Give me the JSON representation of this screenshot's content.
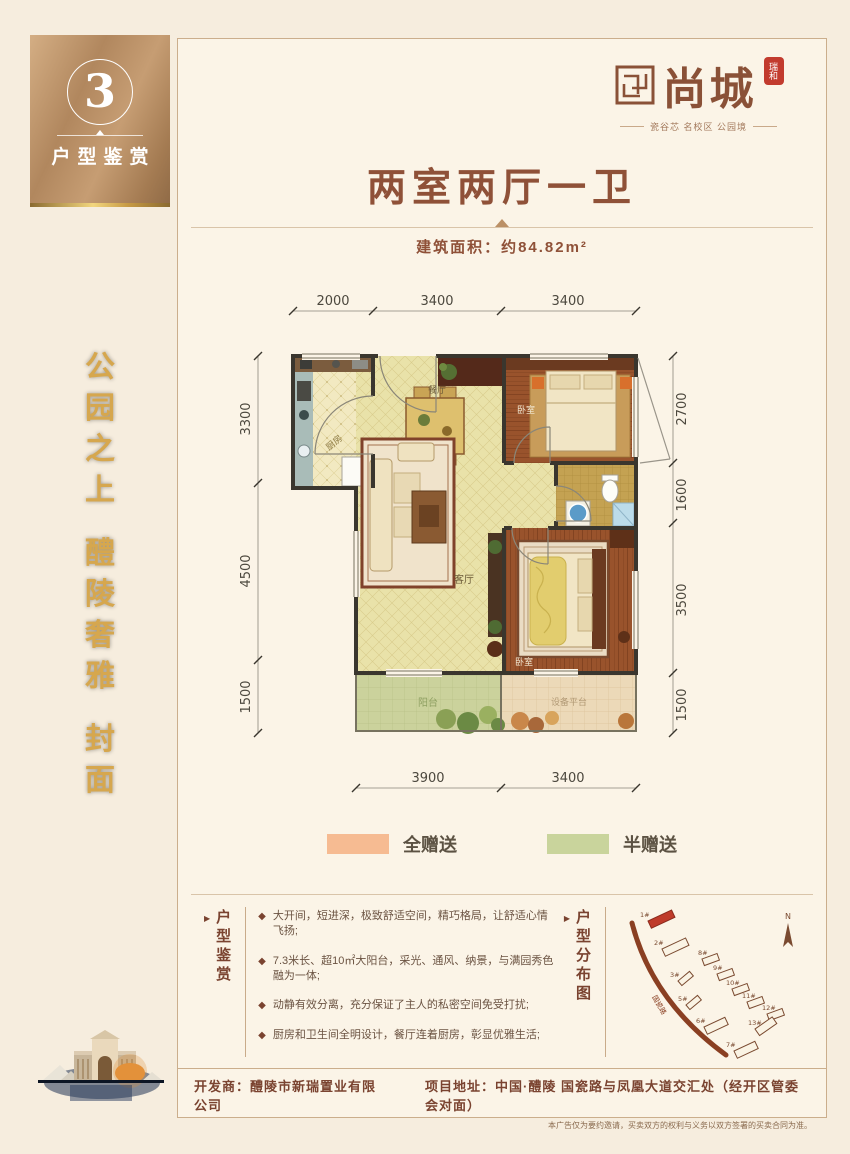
{
  "sidebar": {
    "number": "3",
    "label": "户型鉴赏",
    "slogan_chars": [
      "公",
      "园",
      "之",
      "上",
      "醴",
      "陵",
      "奢",
      "雅",
      "封",
      "面"
    ],
    "colors": {
      "bronze": "#b1875e",
      "navy": "#15223a",
      "gold_text": "#d6a74e"
    }
  },
  "logo": {
    "name": "尚城",
    "seal": "瑞和",
    "tagline": "瓷谷芯 名校区 公园境"
  },
  "header": {
    "title": "两室两厅一卫",
    "area": "建筑面积：约84.82m²"
  },
  "floorplan": {
    "dims_top": [
      "2000",
      "3400",
      "3400"
    ],
    "dims_left": [
      "3300",
      "4500",
      "1500"
    ],
    "dims_right": [
      "2700",
      "1600",
      "3500",
      "1500"
    ],
    "dims_bottom": [
      "3900",
      "3400"
    ],
    "rooms": {
      "kitchen": "厨房",
      "dining": "餐厅",
      "bedroom1": "卧室",
      "living": "客厅",
      "bedroom2": "卧室",
      "balcony": "阳台",
      "equipment": "设备平台"
    }
  },
  "legend": {
    "full": "全赠送",
    "half": "半赠送",
    "full_color": "#f6bb92",
    "half_color": "#c9d49c"
  },
  "features": {
    "label": "户型鉴赏",
    "items": [
      "大开间，短进深，极致舒适空间，精巧格局，让舒适心情飞扬;",
      "7.3米长、超10㎡大阳台，采光、通风、纳景，与满园秀色融为一体;",
      "动静有效分离，充分保证了主人的私密空间免受打扰;",
      "厨房和卫生间全明设计，餐厅连着厨房，彰显优雅生活;"
    ]
  },
  "sitemap": {
    "label": "户型分布图",
    "road": "国瓷路",
    "north": "N",
    "buildings": [
      "1#",
      "2#",
      "3#",
      "5#",
      "6#",
      "7#",
      "8#",
      "9#",
      "10#",
      "11#",
      "12#",
      "13#"
    ]
  },
  "footer": {
    "developer": "开发商：醴陵市新瑞置业有限公司",
    "address": "项目地址：中国·醴陵 国瓷路与凤凰大道交汇处（经开区管委会对面）",
    "disclaimer": "本广告仅为要约邀请，买卖双方的权利与义务以双方签署的买卖合同为准。"
  },
  "icons": {
    "bullet": "◆",
    "arrow": "▶"
  }
}
